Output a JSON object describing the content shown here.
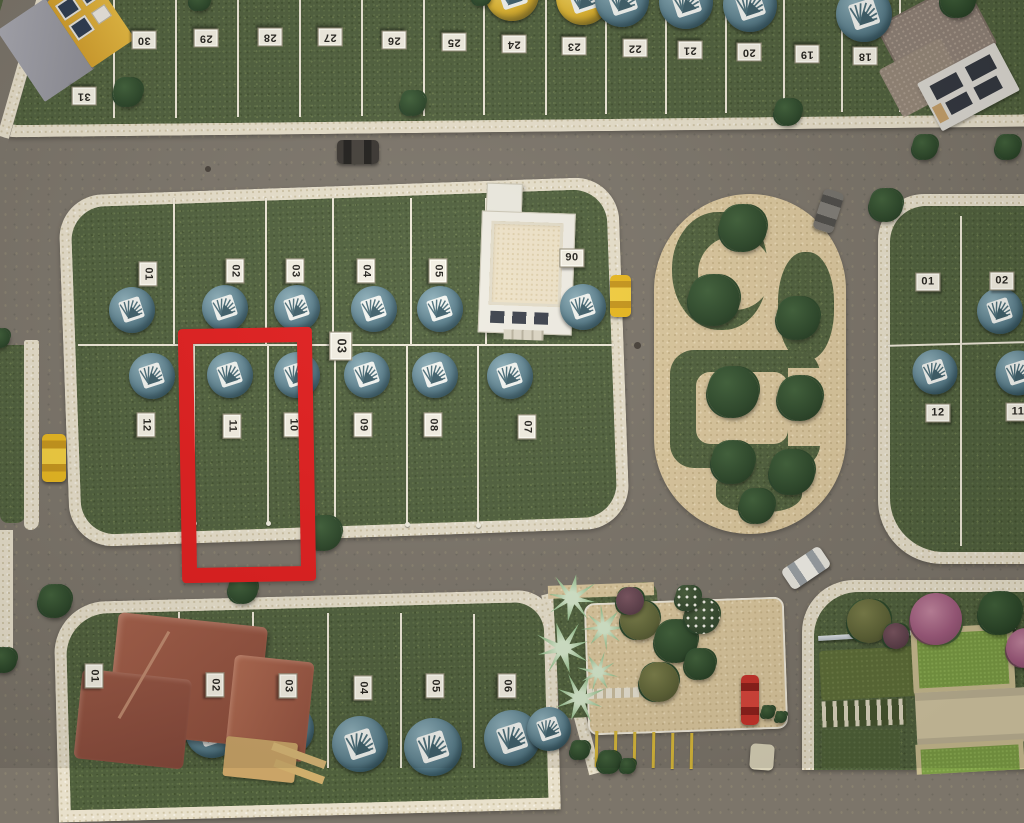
{
  "topStrip": {
    "lots": [
      "31",
      "30",
      "29",
      "28",
      "27",
      "26",
      "25",
      "24",
      "23",
      "22",
      "21",
      "20",
      "19",
      "18"
    ]
  },
  "block03": {
    "label": "03",
    "top_lots": [
      "01",
      "02",
      "03",
      "04",
      "05"
    ],
    "office_lot": "90",
    "bottom_lots": [
      "12",
      "11",
      "10",
      "09",
      "08",
      "07"
    ]
  },
  "rightBlock": {
    "top_lots": [
      "01",
      "02"
    ],
    "bottom_lots": [
      "12",
      "11"
    ]
  },
  "bottomBlock": {
    "lots": [
      "01",
      "02",
      "03",
      "04",
      "05",
      "06"
    ]
  },
  "highlight": {
    "lot": "11",
    "color": "#e11d1d"
  },
  "icons": {
    "dome": "lot-dome-marker",
    "tree": "tree",
    "palm": "palm-plant",
    "car": "car",
    "house": "house",
    "park": "park-paths",
    "highlight": "highlight-rectangle"
  },
  "colors": {
    "road": "#7c756a",
    "grass": "#50603d",
    "curb": "#e8e0cb",
    "dome_teal": "#567c89",
    "dome_yellow": "#ddb32f",
    "car_yellow": "#edc01f",
    "car_red": "#c43028",
    "car_white": "#e9e7df",
    "car_black": "#3a3631",
    "car_gray": "#72706b",
    "sand": "#dbc79d"
  }
}
